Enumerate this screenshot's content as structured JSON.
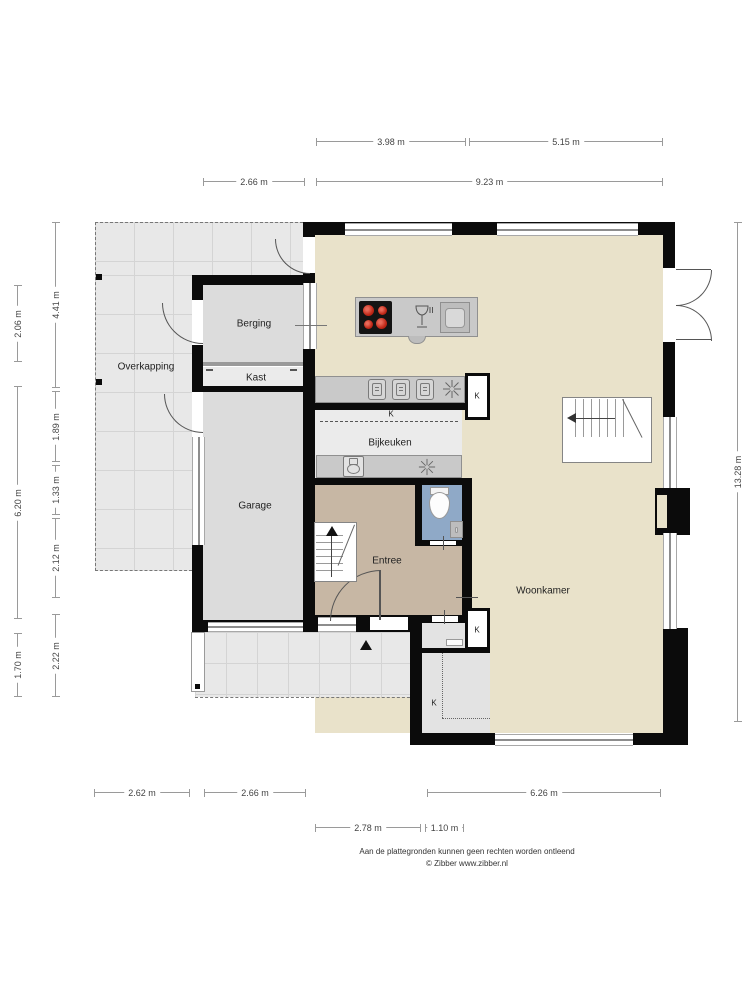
{
  "rooms": {
    "overkapping": "Overkapping",
    "berging": "Berging",
    "kast": "Kast",
    "garage": "Garage",
    "bijkeuken": "Bijkeuken",
    "entree": "Entree",
    "woonkamer": "Woonkamer"
  },
  "k_labels": {
    "kitchen_closet": "K",
    "bijkeuken_area": "K",
    "meterkast": "K",
    "nook": "K"
  },
  "dims": {
    "top_a": "3.98 m",
    "top_b": "5.15 m",
    "top_c": "2.66 m",
    "top_d": "9.23 m",
    "left_a": "2.06 m",
    "left_b": "6.20 m",
    "left_c": "1.70 m",
    "left_d": "4.41 m",
    "left_e": "1.89 m",
    "left_f": "1.33 m",
    "left_g": "2.12 m",
    "left_h": "2.22 m",
    "right_a": "13.28 m",
    "bottom_a": "2.62 m",
    "bottom_b": "2.66 m",
    "bottom_c": "6.26 m",
    "bottom_d": "2.78 m",
    "bottom_e": "1.10 m"
  },
  "footer": {
    "line1": "Aan de plattegronden kunnen geen rechten worden ontleend",
    "line2": "© Zibber www.zibber.nl"
  },
  "colors": {
    "floor_main": "#e9e2ca",
    "floor_entree": "#c7b7a4",
    "floor_toilet": "#8fa9c7",
    "floor_garage": "#dcdcdc",
    "wall": "#0b0b0b",
    "burner": "#c02818"
  }
}
